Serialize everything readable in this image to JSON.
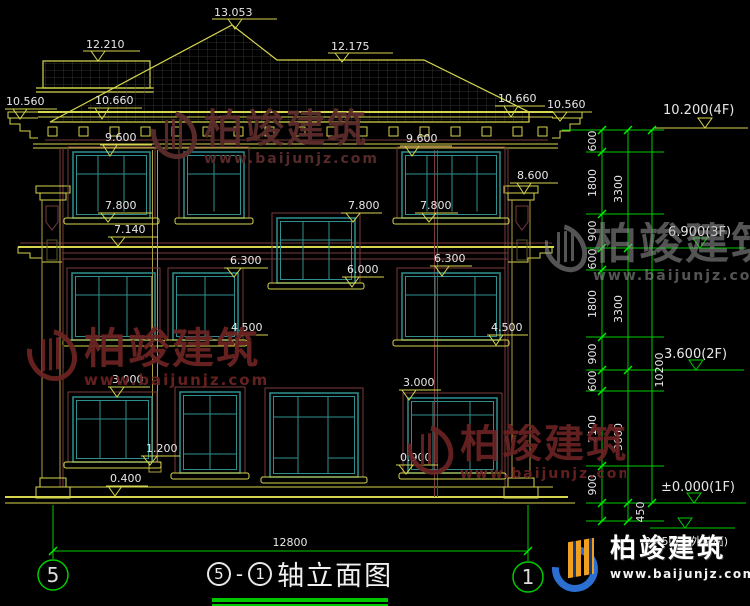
{
  "watermark": {
    "brand": "柏竣建筑",
    "site": "www.baijunjz.com"
  },
  "logo": {
    "brand": "柏竣建筑",
    "site": "www.baijunjz.com"
  },
  "title": {
    "axis_left": "5",
    "dash": "-",
    "axis_right": "1",
    "text": "轴立面图"
  },
  "axis_bubbles": {
    "left": "5",
    "right": "1"
  },
  "bottom_dim": "12800",
  "roof_marks": {
    "peak": "13.053",
    "left_upper": "12.210",
    "right_upper": "12.175",
    "far_left": "10.560",
    "left": "10.660",
    "right": "10.660",
    "far_right": "10.560"
  },
  "marks": {
    "eave_left": "9.600",
    "eave_right": "9.600",
    "pilaster_top": "8.600",
    "w3_left": "7.800",
    "w3_mid": "7.800",
    "w3_right": "7.800",
    "band": "7.140",
    "w2_top_left": "6.300",
    "w2_top_right": "6.300",
    "stair_sill": "6.000",
    "w2_sill_left": "4.500",
    "w2_sill_right": "4.500",
    "w1_top_left": "3.000",
    "w1_top_right": "3.000",
    "w1_sill_left": "1.200",
    "w1_sill_right": "0.900",
    "plinth": "0.400"
  },
  "floors": {
    "f4": "10.200(4F)",
    "f3": "6.900(3F)",
    "f2": "3.600(2F)",
    "f1": "±0.000(1F)",
    "ground": "-0.450(室外地面)"
  },
  "chain": {
    "segments": [
      "600",
      "1800",
      "900",
      "600",
      "1800",
      "900",
      "600",
      "2100",
      "900"
    ],
    "ground_segment": "450",
    "groups": [
      "3300",
      "3300",
      "3600"
    ],
    "total": "10200"
  }
}
